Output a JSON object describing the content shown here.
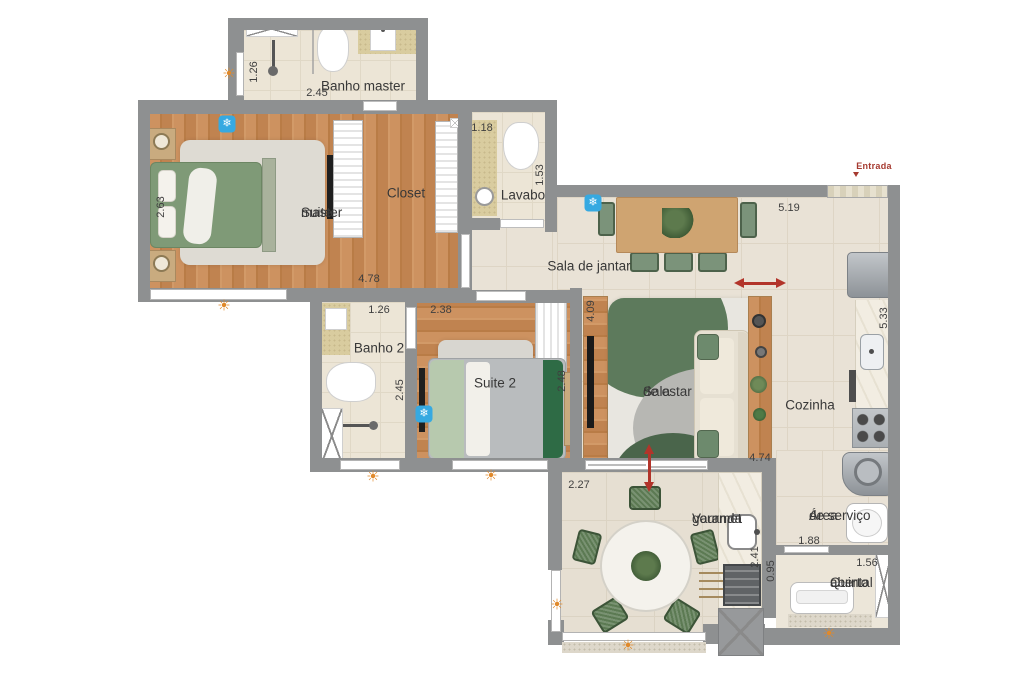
{
  "plan": {
    "rooms": {
      "banho_master": {
        "label": "Banho master"
      },
      "suite_master": {
        "line1": "Suite",
        "line2": "master"
      },
      "closet": {
        "label": "Closet"
      },
      "lavabo": {
        "label": "Lavabo"
      },
      "sala_jantar": {
        "label": "Sala de jantar"
      },
      "banho_2": {
        "label": "Banho 2"
      },
      "suite_2": {
        "label": "Suite 2"
      },
      "sala_estar": {
        "line1": "Sala",
        "line2": "de estar"
      },
      "cozinha": {
        "label": "Cozinha"
      },
      "varanda": {
        "line1": "Varanda",
        "line2": "gourmet"
      },
      "area_servico": {
        "line1": "Área",
        "line2": "de serviço"
      },
      "quintal": {
        "line1": "Quintal",
        "line2": "aberto"
      }
    },
    "entry": {
      "label": "Entrada"
    },
    "dims": {
      "banho_master_h": "1.26",
      "banho_master_w": "2.45",
      "suite_master_bed": "2.63",
      "suite_master_w": "4.78",
      "lavabo_w": "1.18",
      "lavabo_h": "1.53",
      "sala_jantar_w": "5.19",
      "banho_2_w": "1.26",
      "suite_2_door": "2.38",
      "banho_2_h": "2.45",
      "suite_2_h": "2.48",
      "sala_estar_h": "4.09",
      "cozinha_h": "5.33",
      "sala_estar_w": "4.74",
      "varanda_w": "2.27",
      "varanda_counter": "2.41",
      "quintal_offset": "0.95",
      "area_servico_w": "1.88",
      "quintal_w": "1.56"
    },
    "icons": {
      "sun": "☀",
      "ac": "❄"
    },
    "colors": {
      "wall": "#8e9091",
      "accent_red": "#b2342a",
      "ac_blue": "#36a9e1",
      "sun_orange": "#e0892b"
    }
  }
}
